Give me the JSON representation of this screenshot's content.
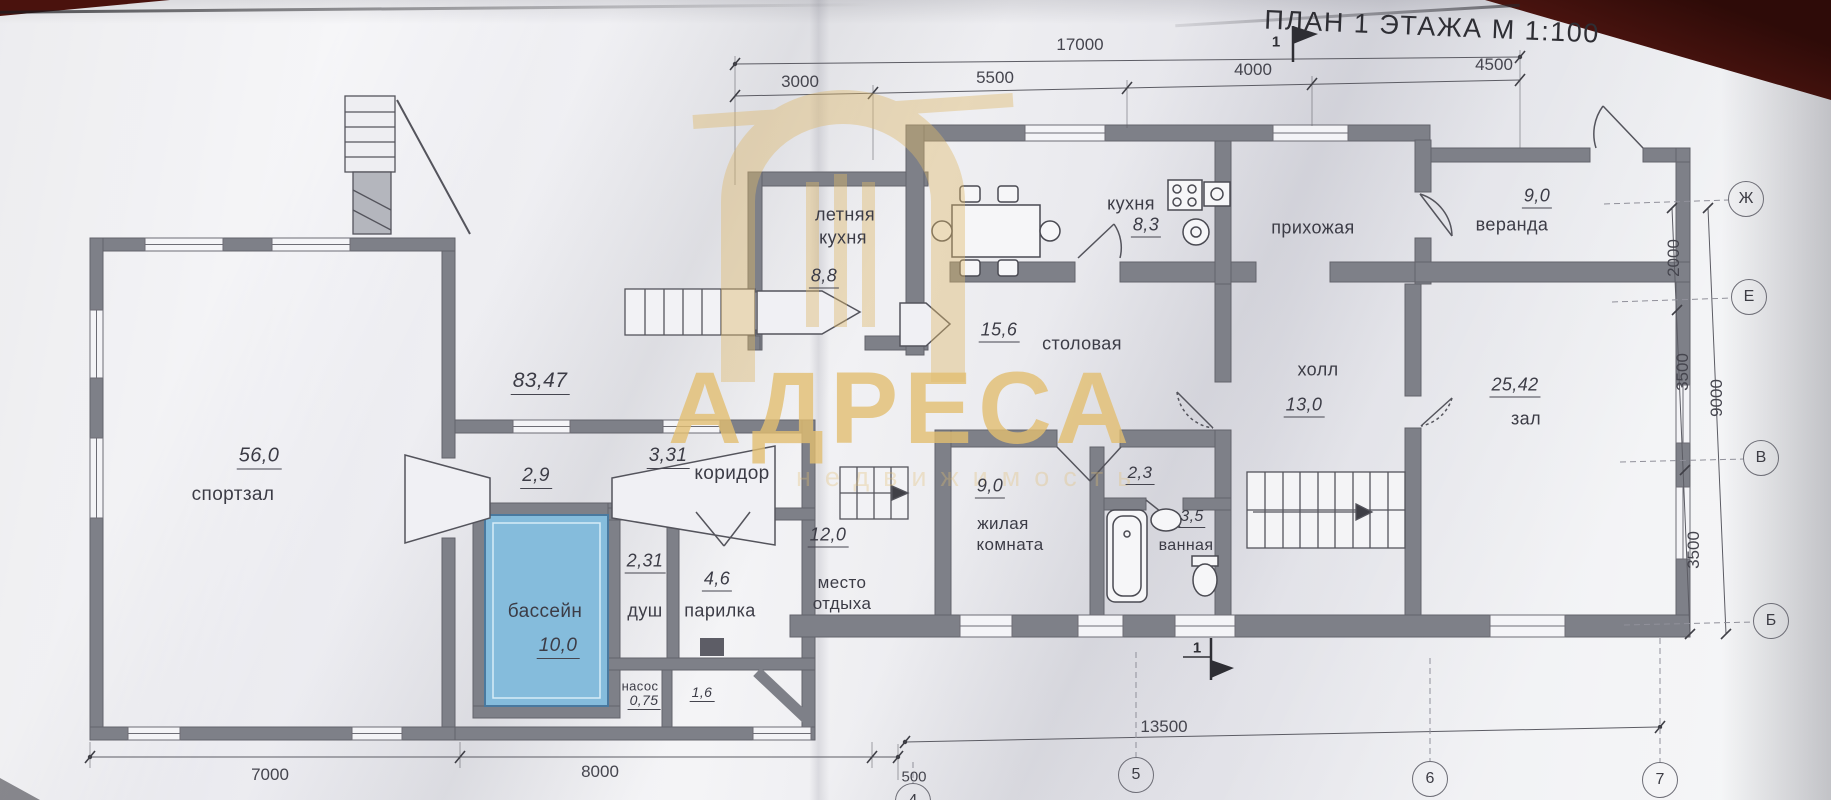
{
  "title": "ПЛАН 1 ЭТАЖА М 1:100",
  "watermark": {
    "name": "АДРЕСА",
    "tagline": "недвижимость"
  },
  "rooms": {
    "sportzal": {
      "area": "56,0",
      "name": "спортзал"
    },
    "pool_house_total": {
      "area": "83,47"
    },
    "vestibule": {
      "area": "2,9"
    },
    "koridor": {
      "area": "3,31",
      "name": "коридор"
    },
    "bassein": {
      "area": "10,0",
      "name": "бассейн"
    },
    "dush": {
      "area": "2,31",
      "name": "душ"
    },
    "parilka": {
      "area": "4,6",
      "name": "парилка"
    },
    "nasos": {
      "area": "0,75",
      "name": "насос"
    },
    "room_1_6": {
      "area": "1,6"
    },
    "letnyaya_kuhnya": {
      "area": "8,8",
      "name_line1": "летняя",
      "name_line2": "кухня"
    },
    "kuhnya": {
      "area": "8,3",
      "name": "кухня"
    },
    "prihozhaya": {
      "name": "прихожая"
    },
    "veranda": {
      "area": "9,0",
      "name": "веранда"
    },
    "stolovaya": {
      "area": "15,6",
      "name": "столовая"
    },
    "holl": {
      "area": "13,0",
      "name": "холл"
    },
    "zal": {
      "area": "25,42",
      "name": "зал"
    },
    "mesto_otdyha": {
      "area": "12,0",
      "name_line1": "место",
      "name_line2": "отдыха"
    },
    "zhilaya": {
      "area": "9,0",
      "name_line1": "жилая",
      "name_line2": "комната"
    },
    "hall_2_3": {
      "area": "2,3"
    },
    "vannaya": {
      "area": "3,5",
      "name": "ванная"
    }
  },
  "dimensions": {
    "top_total": "17000",
    "top_segments": [
      "3000",
      "5500",
      "4000",
      "4500"
    ],
    "bottom_left": [
      "7000",
      "8000",
      "500"
    ],
    "bottom_right_total": "13500",
    "right_segments": [
      "2000",
      "3500",
      "3500"
    ],
    "right_total": "9000"
  },
  "grid": {
    "right": [
      "Ж",
      "Е",
      "В",
      "Б"
    ],
    "bottom": [
      "4",
      "5",
      "6",
      "7"
    ]
  },
  "section_mark": "1",
  "colors": {
    "paper": "#ececf0",
    "wall": "#7e8088",
    "pool_water": "#85bcdc",
    "watermark_gold": "#dfb96b",
    "backdrop_maroon": "#4a120d",
    "ink": "#3c3c46"
  }
}
